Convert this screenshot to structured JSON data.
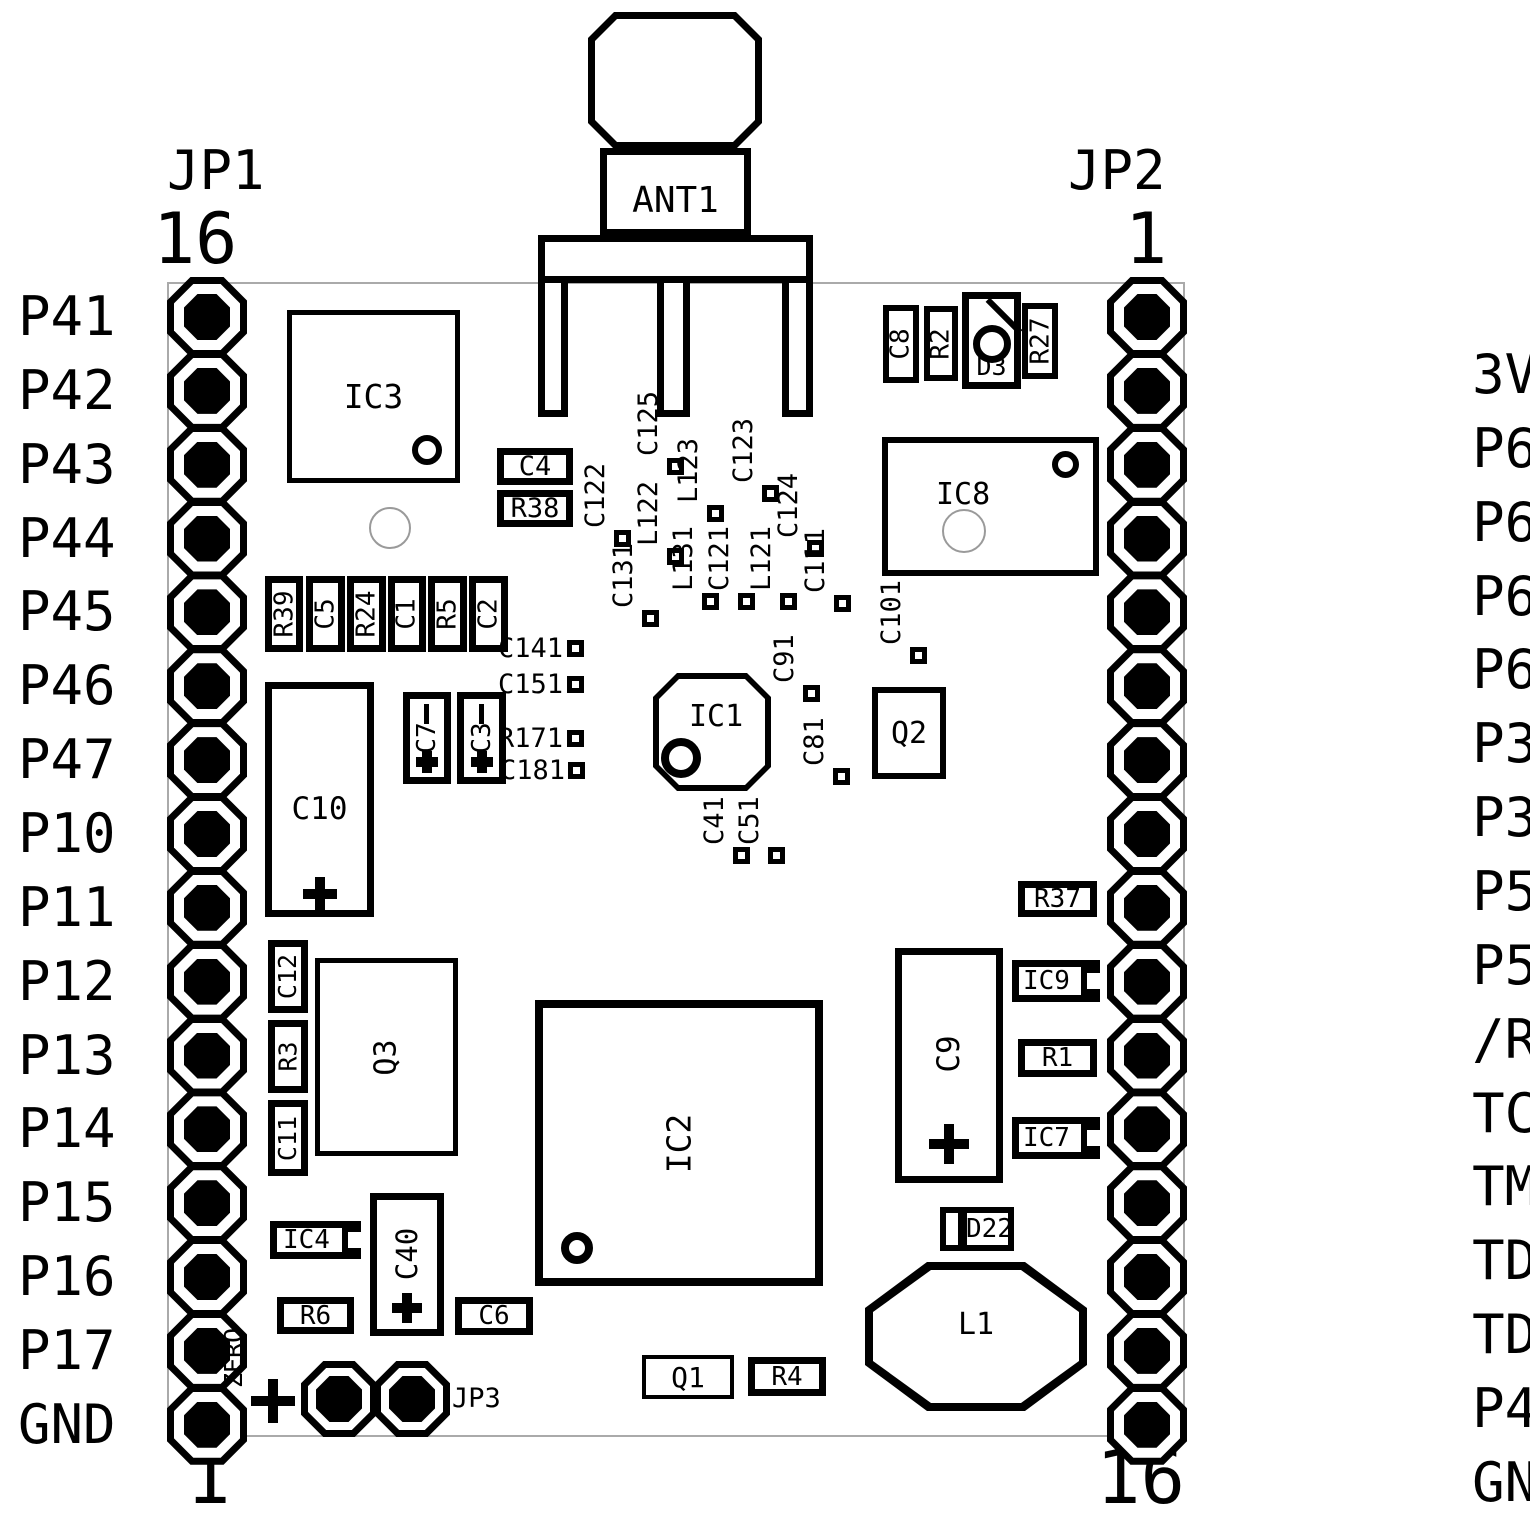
{
  "board": {
    "outline_color": "#aaaaaa",
    "silk_color": "#000000",
    "bg": "#ffffff"
  },
  "antenna": {
    "label": "ANT1"
  },
  "headers": {
    "jp1": {
      "label": "JP1",
      "top_pin": "16",
      "bottom_pin": "1",
      "pins": [
        "P41",
        "P42",
        "P43",
        "P44",
        "P45",
        "P46",
        "P47",
        "P10",
        "P11",
        "P12",
        "P13",
        "P14",
        "P15",
        "P16",
        "P17",
        "GND"
      ]
    },
    "jp2": {
      "label": "JP2",
      "top_pin": "1",
      "bottom_pin": "16",
      "pins": [
        {
          "name": "3V",
          "signal": ""
        },
        {
          "name": "P67",
          "signal": "DAC1"
        },
        {
          "name": "P66",
          "signal": "DAC0"
        },
        {
          "name": "P65",
          "signal": "ADC5"
        },
        {
          "name": "P64",
          "signal": "ADC4"
        },
        {
          "name": "P37",
          "signal": "RxD1"
        },
        {
          "name": "P36",
          "signal": "TxD1"
        },
        {
          "name": "P54",
          "signal": ""
        },
        {
          "name": "P55",
          "signal": ""
        },
        {
          "name": "/RST_NMI",
          "signal": ""
        },
        {
          "name": "TCK",
          "signal": ""
        },
        {
          "name": "TMS",
          "signal": ""
        },
        {
          "name": "TDI",
          "signal": ""
        },
        {
          "name": "TDO/TDI",
          "signal": ""
        },
        {
          "name": "P40",
          "signal": ""
        },
        {
          "name": "GND",
          "signal": ""
        }
      ]
    },
    "jp3": {
      "label": "JP3",
      "adjacent_text": "ZERO"
    }
  },
  "components": {
    "ic1": "IC1",
    "ic2": "IC2",
    "ic3": "IC3",
    "ic4": "IC4",
    "ic7": "IC7",
    "ic8": "IC8",
    "ic9": "IC9",
    "q1": "Q1",
    "q2": "Q2",
    "q3": "Q3",
    "l1": "L1",
    "d3": "D3",
    "d22": "D22",
    "c1": "C1",
    "c2": "C2",
    "c3": "C3",
    "c4": "C4",
    "c5": "C5",
    "c6": "C6",
    "c7": "C7",
    "c8": "C8",
    "c9": "C9",
    "c10": "C10",
    "c11": "C11",
    "c12": "C12",
    "c40": "C40",
    "r1": "R1",
    "r2": "R2",
    "r3": "R3",
    "r4": "R4",
    "r5": "R5",
    "r6": "R6",
    "r24": "R24",
    "r27": "R27",
    "r37": "R37",
    "r38": "R38",
    "r39": "R39"
  },
  "smd_pads": {
    "c122": "C122",
    "c125": "C125",
    "l122": "L122",
    "c131": "C131",
    "l123": "L123",
    "l131": "L131",
    "c121": "C121",
    "c123": "C123",
    "l121": "L121",
    "c124": "C124",
    "c111": "C111",
    "c91": "C91",
    "c81": "C81",
    "c101": "C101",
    "c41": "C41",
    "c51": "C51",
    "c141": "C141",
    "c151": "C151",
    "r171": "R171",
    "c181": "C181"
  }
}
